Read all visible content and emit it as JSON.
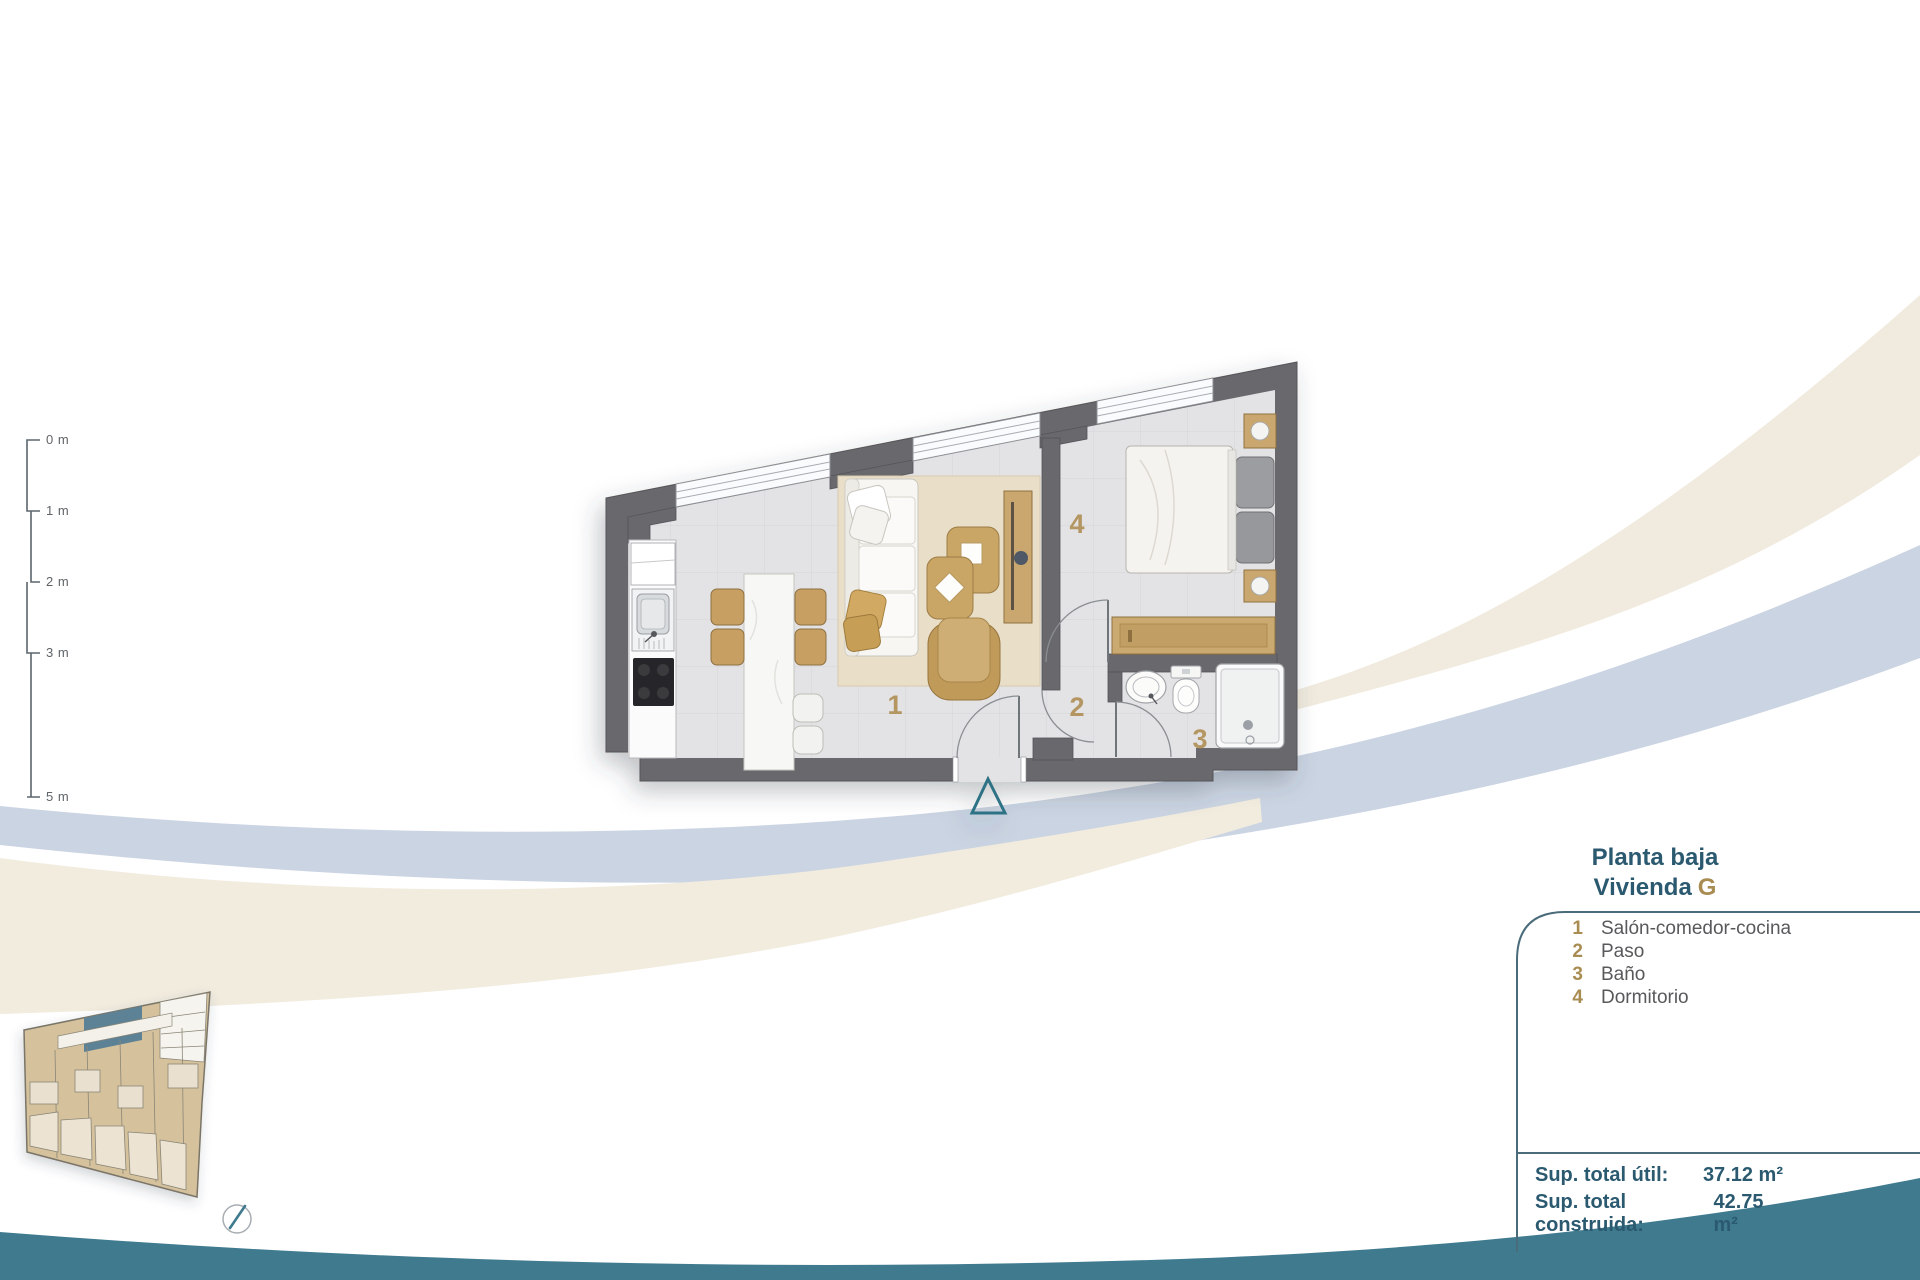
{
  "header": {
    "floor_title": "Planta baja",
    "unit_word": "Vivienda",
    "unit_letter": "G"
  },
  "legend": {
    "items": [
      {
        "num": "1",
        "label": "Salón-comedor-cocina"
      },
      {
        "num": "2",
        "label": "Paso"
      },
      {
        "num": "3",
        "label": "Baño"
      },
      {
        "num": "4",
        "label": "Dormitorio"
      }
    ]
  },
  "totals": {
    "rows": [
      {
        "label": "Sup. total útil:",
        "value": "37.12 m²"
      },
      {
        "label": "Sup. total construida:",
        "value": "42.75 m²"
      }
    ]
  },
  "scale_bar": {
    "labels": [
      "0 m",
      "1 m",
      "2 m",
      "3 m",
      "5 m"
    ]
  },
  "floor_plan": {
    "room_numbers": [
      "1",
      "2",
      "3",
      "4"
    ]
  },
  "colors": {
    "accent_teal": "#2b5a70",
    "accent_gold": "#a98c52",
    "footer_wave_teal": "#3f7a8f",
    "band_blue": "#cbd4e2",
    "band_cream": "#f1ebdf",
    "wall_gray": "#69686c",
    "floor_gray": "#e3e2e4",
    "rug_beige": "#e9dfc9",
    "furniture_tan": "#c9a566",
    "highlighted_unit": "#5d8296"
  }
}
